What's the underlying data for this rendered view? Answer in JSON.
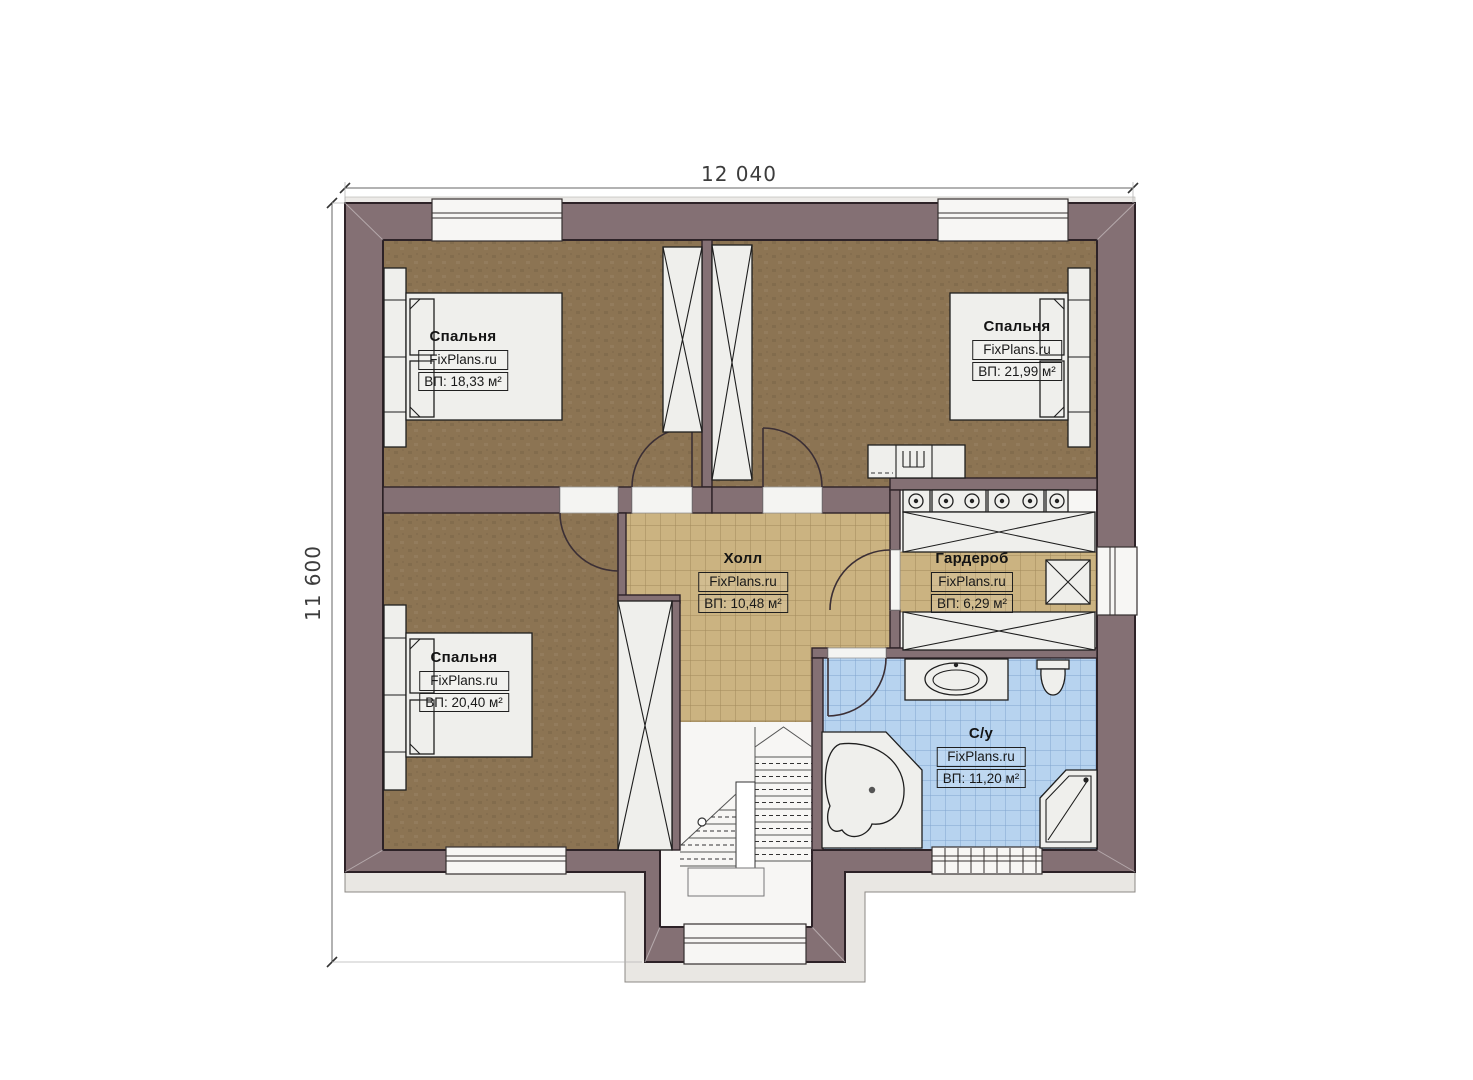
{
  "dimensions": {
    "width_label": "12 040",
    "height_label": "11 600"
  },
  "rooms": [
    {
      "id": "bedroom-top-left",
      "name": "Спальня",
      "brand": "FixPlans.ru",
      "area": "ВП: 18,33 м²"
    },
    {
      "id": "bedroom-top-right",
      "name": "Спальня",
      "brand": "FixPlans.ru",
      "area": "ВП: 21,99 м²"
    },
    {
      "id": "hall",
      "name": "Холл",
      "brand": "FixPlans.ru",
      "area": "ВП: 10,48 м²"
    },
    {
      "id": "wardrobe",
      "name": "Гардероб",
      "brand": "FixPlans.ru",
      "area": "ВП: 6,29 м²"
    },
    {
      "id": "bedroom-bottom-left",
      "name": "Спальня",
      "brand": "FixPlans.ru",
      "area": "ВП: 20,40 м²"
    },
    {
      "id": "bathroom",
      "name": "С/у",
      "brand": "FixPlans.ru",
      "area": "ВП: 11,20 м²"
    }
  ],
  "colors": {
    "wall": "#847074",
    "wall_outline": "#2d2227",
    "bedroom_floor": "#8c7453",
    "hall_floor": "#cbb381",
    "bath_floor": "#b7d3ef",
    "fixture": "#efefec",
    "band": "#e9e7e3"
  }
}
